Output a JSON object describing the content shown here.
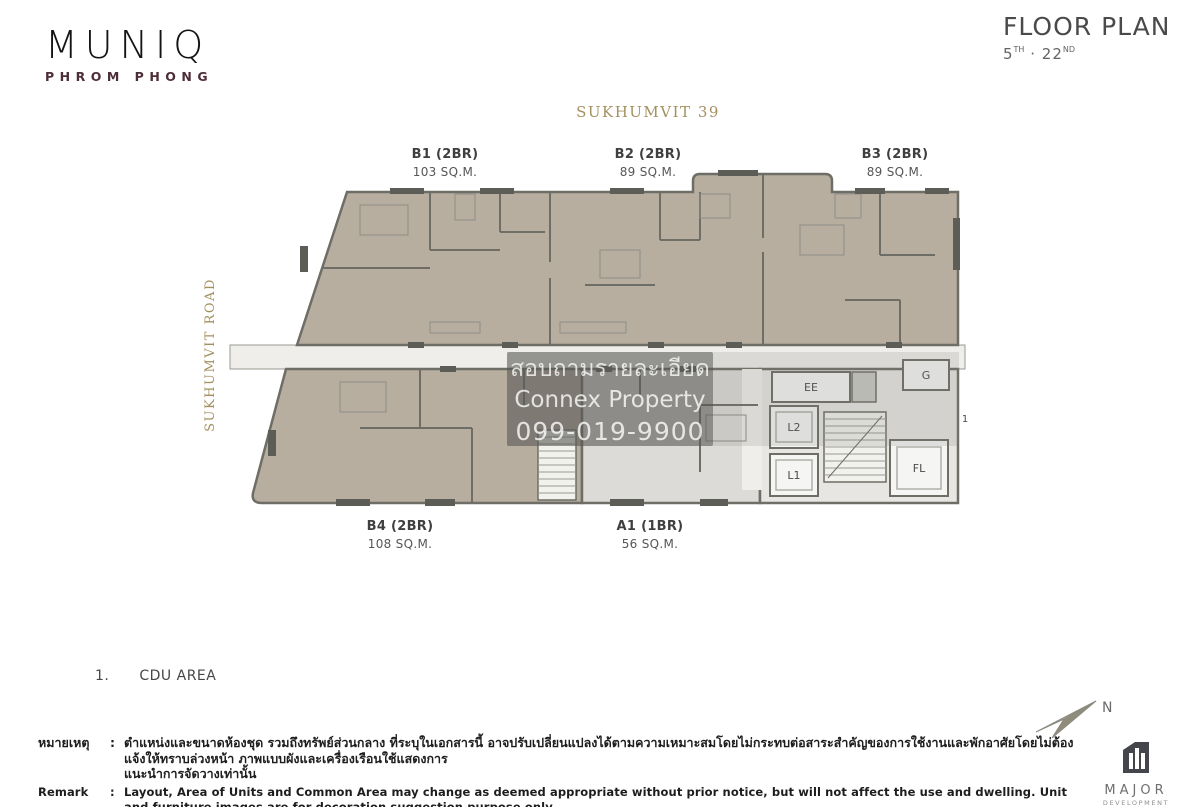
{
  "header": {
    "logo": {
      "title": "MUNIQ",
      "subtitle": "PHROM PHONG"
    },
    "floor_plan": {
      "title": "FLOOR PLAN",
      "from": "5",
      "from_suffix": "TH",
      "separator": "·",
      "to": "22",
      "to_suffix": "ND"
    }
  },
  "plan": {
    "street_top": "SUKHUMVIT 39",
    "street_left": "SUKHUMVIT ROAD",
    "units": [
      {
        "name": "B1 (2BR)",
        "area": "103 SQ.M."
      },
      {
        "name": "B2 (2BR)",
        "area": "89 SQ.M."
      },
      {
        "name": "B3 (2BR)",
        "area": "89 SQ.M."
      },
      {
        "name": "B4 (2BR)",
        "area": "108 SQ.M."
      },
      {
        "name": "A1 (1BR)",
        "area": "56 SQ.M."
      }
    ],
    "rooms": {
      "ee": "EE",
      "g": "G",
      "l2": "L2",
      "l1": "L1",
      "fl": "FL",
      "cdu_marker": "1"
    }
  },
  "watermark": {
    "line1": "สอบถามรายละเอียด",
    "line2": "Connex Property",
    "line3": "099-019-9900"
  },
  "legend": {
    "number": "1.",
    "label": "CDU AREA"
  },
  "compass": {
    "north": "N"
  },
  "footer": {
    "thai_label": "หมายเหตุ",
    "colon": ":",
    "thai_line1": "ตำแหน่งและขนาดห้องชุด รวมถึงทรัพย์ส่วนกลาง ที่ระบุในเอกสารนี้ อาจปรับเปลี่ยนแปลงได้ตามความเหมาะสมโดยไม่กระทบต่อสาระสำคัญของการใช้งานและพักอาศัยโดยไม่ต้องแจ้งให้ทราบล่วงหน้า ภาพแบบผังและเครื่องเรือนใช้แสดงการ",
    "thai_line2": "แนะนำการจัดวางเท่านั้น",
    "remark_label": "Remark",
    "remark_line1": "Layout, Area of Units and Common Area may change as deemed appropriate without prior notice, but will not affect the use and dwelling. Unit and furniture images are for decoration suggestion purpose only.",
    "remark_line2": "Intrior and decoration in the unit are according to company's terms and conditions.",
    "developer": {
      "name": "MAJOR",
      "subtitle": "DEVELOPMENT"
    }
  },
  "colors": {
    "gold": "#a3905e",
    "unit_beige": "#b7aea0",
    "wall_gray": "#6e6e66",
    "logo_maroon": "#4d2d36",
    "watermark_box": "rgba(84,84,80,0.52)"
  }
}
